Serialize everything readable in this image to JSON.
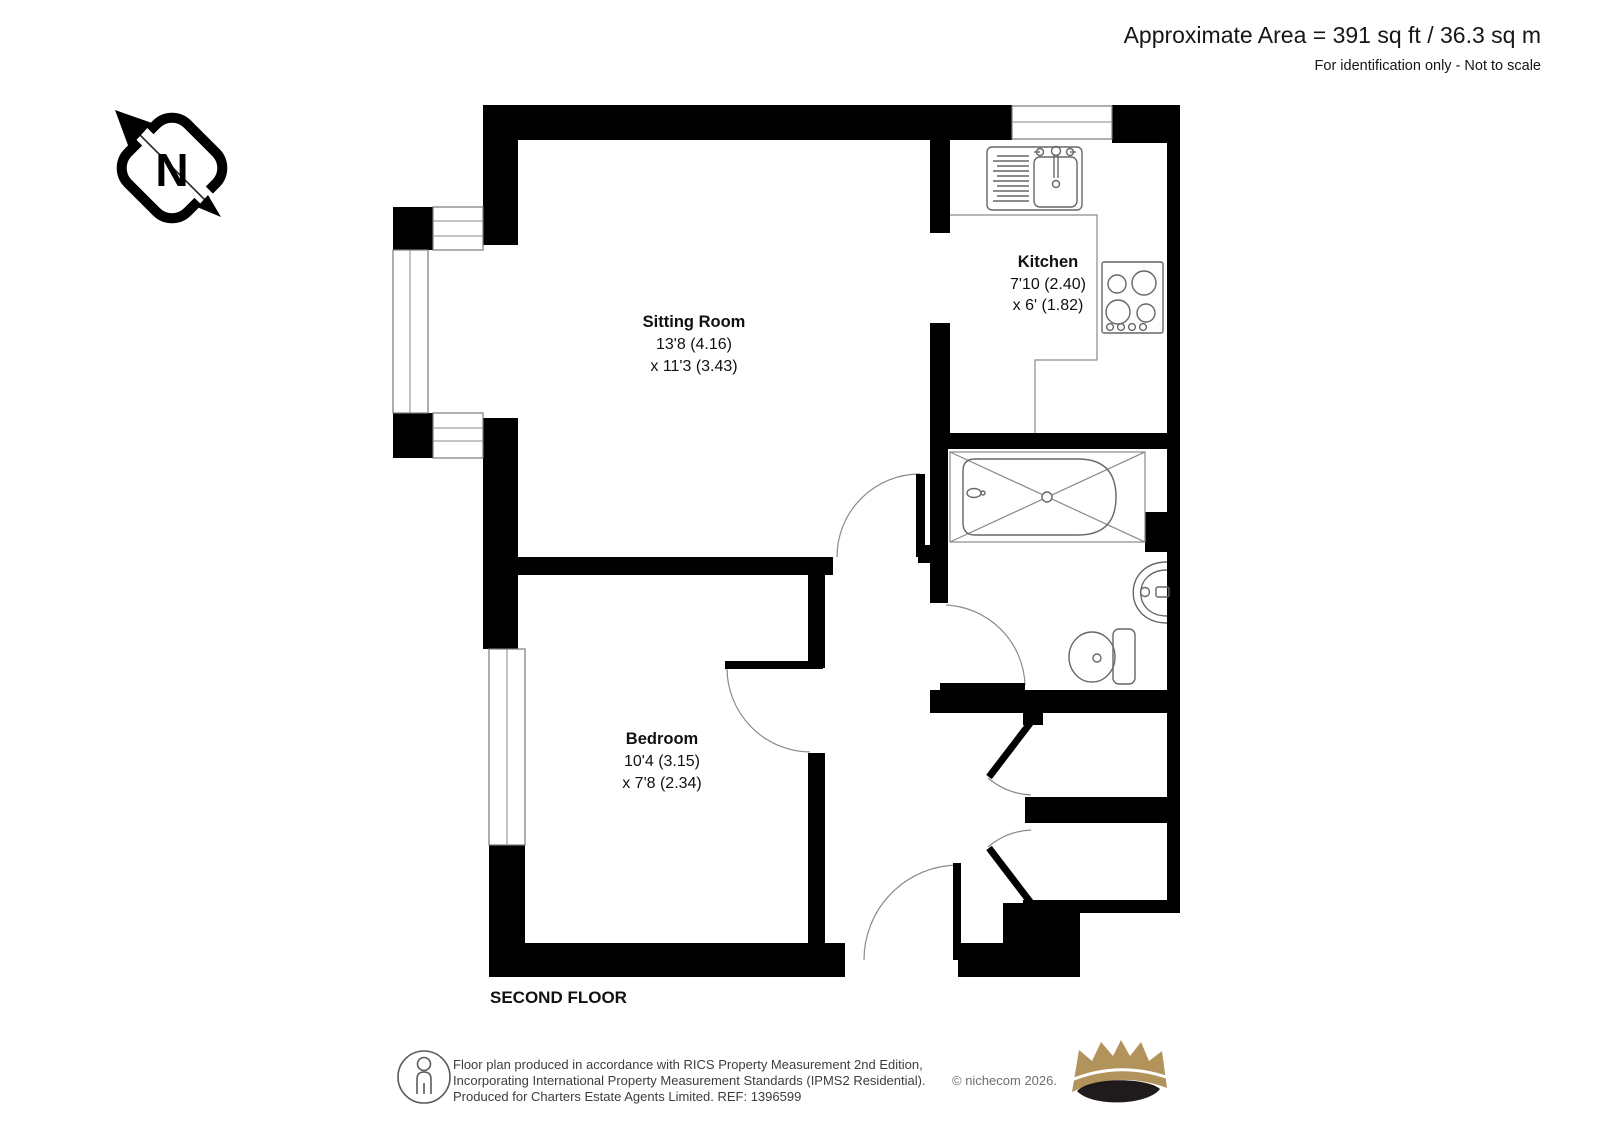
{
  "header": {
    "approx_area": "Approximate Area = 391 sq ft / 36.3 sq m",
    "disclaimer": "For identification only - Not to scale"
  },
  "compass": {
    "label": "N"
  },
  "rooms": {
    "sitting_room": {
      "name": "Sitting Room",
      "dim1": "13'8 (4.16)",
      "dim2": "x 11'3 (3.43)"
    },
    "kitchen": {
      "name": "Kitchen",
      "dim1": "7'10 (2.40)",
      "dim2": "x 6' (1.82)"
    },
    "bedroom": {
      "name": "Bedroom",
      "dim1": "10'4 (3.15)",
      "dim2": "x 7'8 (2.34)"
    }
  },
  "floor_label": "SECOND FLOOR",
  "footer": {
    "line1": "Floor plan produced in accordance with RICS Property Measurement 2nd Edition,",
    "line2": "Incorporating International Property Measurement Standards (IPMS2 Residential).",
    "copyright": "© nichecom 2026.",
    "line3": "Produced for Charters Estate Agents Limited.   REF: 1396599"
  },
  "colors": {
    "walls": "#000000",
    "fixtures": "#676767",
    "crown_gold": "#b2935b",
    "crown_dark": "#1f1b1c"
  }
}
